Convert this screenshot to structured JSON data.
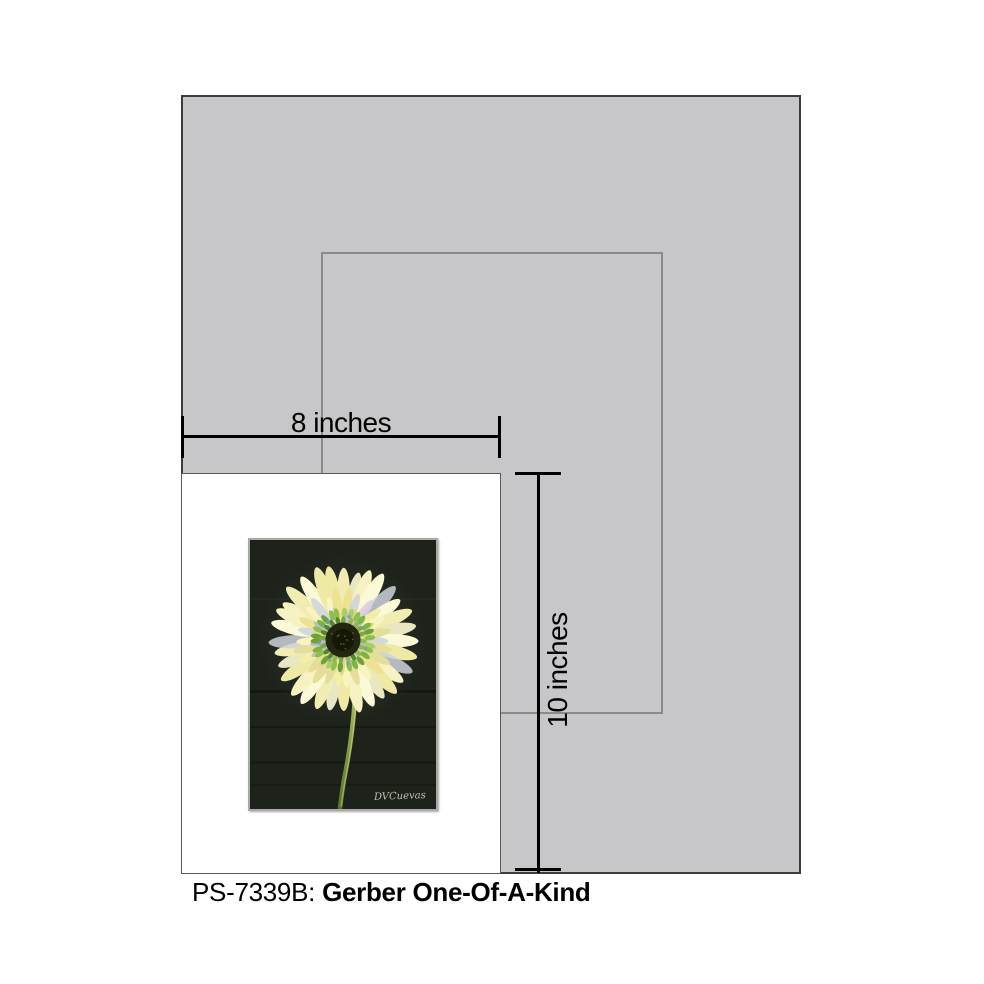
{
  "page": {
    "background": "#ffffff"
  },
  "mockup": {
    "mat_color": "#c7c7c9",
    "opening_outline_color": "#8a8a8a",
    "print_background": "#ffffff"
  },
  "dimensions": {
    "width_label": "8 inches",
    "height_label": "10 inches",
    "line_color": "#000000"
  },
  "caption": {
    "sku": "PS-7339B:",
    "title": "Gerber One-Of-A-Kind"
  },
  "artwork": {
    "subject": "gerbera-daisy-painting",
    "signature": "DVCuevas",
    "signature_color": "#d9dcc8",
    "canvas_color": "#1d221b",
    "frame_color": "#a9a9a9",
    "petal_palette": [
      "#f6f2c1",
      "#efe9a6",
      "#fcf9d8",
      "#f1ecb2",
      "#e9e7c2"
    ],
    "petal_inner_palette": [
      "#f4eda8",
      "#ece292",
      "#f9f4bd",
      "#e4de9a"
    ],
    "petal_accent_colors": [
      "#ccd2db",
      "#d8cede"
    ],
    "petal_short_palette": [
      "#dcd98e",
      "#c9cdb4",
      "#b7c0cf"
    ],
    "floret_palette": [
      "#8fbf4a",
      "#6da336",
      "#a9cf63",
      "#7ab53e"
    ],
    "floret_inner_palette": [
      "#55842a",
      "#7aa83e",
      "#8fb84d"
    ],
    "floret_accent_color": "#8796ae",
    "center_color": "#232610",
    "center_core_color": "#141607",
    "center_dot_color": "#77763a",
    "stem_color_top": "#a8b959",
    "stem_color_bottom": "#55722d",
    "stem_highlight": "#d6e08e"
  }
}
